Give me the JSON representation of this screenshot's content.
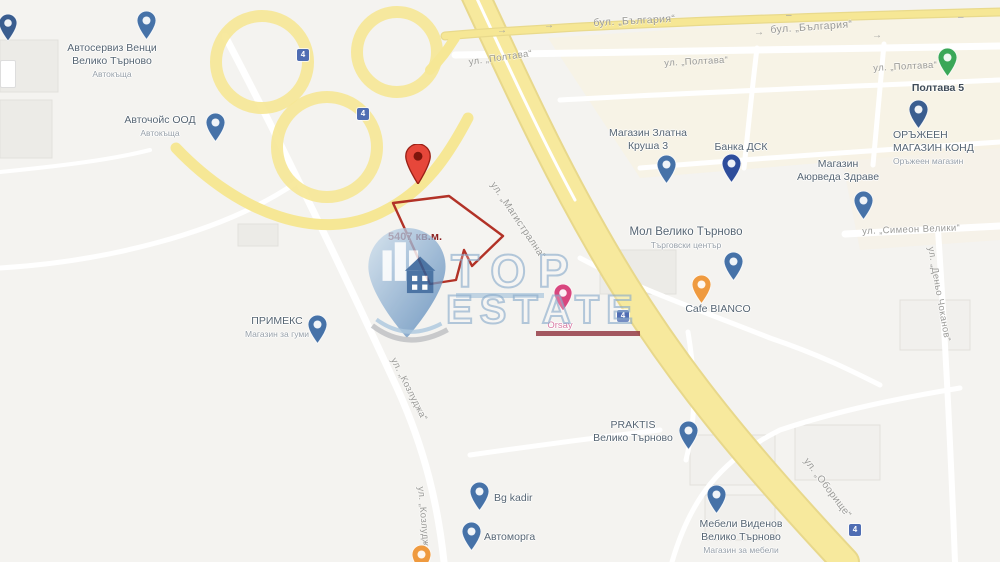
{
  "map_title": "Veliko Tarnovo map with plot outline",
  "parcel": {
    "area_label": "5407 кв.м.",
    "outline_color": "#b23227"
  },
  "marker": {
    "color": "#e6473a",
    "dot_color": "#7e150c"
  },
  "watermark": {
    "line1": "TOP",
    "line2": "ESTATE",
    "letter_stroke": "#88aaca",
    "underline_top_color": "#a9c4dc",
    "underline_estate_color": "#8e2f3c",
    "logo": "house-pin-logo"
  },
  "road_shield_label": "4",
  "pois": [
    {
      "id": "dark-pin-topleft",
      "pin": {
        "x": 8,
        "y": 14,
        "color": "#3a5d8f",
        "scale": 0.9
      }
    },
    {
      "id": "avtoserviz-venci",
      "pin": {
        "x": 146,
        "y": 11,
        "color": "#4672a8",
        "scale": 0.95
      },
      "label": {
        "x": 112,
        "y": 42,
        "align": "center",
        "lines": [
          "Автосервиз Венци",
          "Велико Търново"
        ],
        "sub": "Автокъща"
      }
    },
    {
      "id": "avtochois-ood",
      "pin": {
        "x": 215,
        "y": 113,
        "color": "#4672a8",
        "scale": 0.95
      },
      "label": {
        "x": 160,
        "y": 114,
        "align": "center",
        "lines": [
          "Авточойс ООД"
        ],
        "sub": "Автокъща"
      }
    },
    {
      "id": "magazin-zlatna-krusha",
      "pin": {
        "x": 666,
        "y": 155,
        "color": "#4672a8",
        "scale": 0.95
      },
      "label": {
        "x": 648,
        "y": 127,
        "align": "center",
        "lines": [
          "Магазин Златна",
          "Круша 3"
        ]
      }
    },
    {
      "id": "banka-dsk",
      "pin": {
        "x": 731,
        "y": 154,
        "color": "#2e4d9b",
        "scale": 0.95
      },
      "label": {
        "x": 741,
        "y": 141,
        "align": "center",
        "lines": [
          "Банка ДСК"
        ]
      }
    },
    {
      "id": "magazin-ayurveda-zdrave",
      "pin": {
        "x": 863,
        "y": 191,
        "color": "#4672a8",
        "scale": 0.95
      },
      "label": {
        "x": 838,
        "y": 158,
        "align": "center",
        "lines": [
          "Магазин",
          "Аюрведа Здраве"
        ]
      }
    },
    {
      "id": "poltava-5",
      "pin": {
        "x": 947,
        "y": 48,
        "color": "#3aa757",
        "scale": 0.95
      },
      "label": {
        "x": 938,
        "y": 82,
        "align": "center",
        "lines": [
          "Полтава 5"
        ],
        "color": "#3f4b57",
        "bold": true
      }
    },
    {
      "id": "orazheen-magazin-kond",
      "pin": {
        "x": 918,
        "y": 100,
        "color": "#3a5d8f",
        "scale": 0.95
      },
      "label": {
        "x": 893,
        "y": 129,
        "align": "left",
        "lines": [
          "ОРЪЖЕЕН",
          "МАГАЗИН КОНД"
        ],
        "sub": "Оръжеен магазин"
      }
    },
    {
      "id": "mol-veliko-tarnovo",
      "pin": {
        "x": 733,
        "y": 252,
        "color": "#4672a8",
        "scale": 0.95
      },
      "label": {
        "x": 686,
        "y": 225,
        "align": "center",
        "lines": [
          "Мол Велико Търново"
        ],
        "sub": "Търговски център",
        "size": 11.5
      }
    },
    {
      "id": "cafe-bianco",
      "pin": {
        "x": 701,
        "y": 275,
        "color": "#ef9a3f",
        "scale": 0.95
      },
      "label": {
        "x": 718,
        "y": 303,
        "align": "center",
        "lines": [
          "Cafe BIANCO"
        ]
      }
    },
    {
      "id": "primeks",
      "pin": {
        "x": 317,
        "y": 315,
        "color": "#4672a8",
        "scale": 0.95
      },
      "label": {
        "x": 277,
        "y": 315,
        "align": "center",
        "lines": [
          "ПРИМЕКС"
        ],
        "sub": "Магазин за гуми"
      }
    },
    {
      "id": "praktis",
      "pin": {
        "x": 688,
        "y": 421,
        "color": "#4672a8",
        "scale": 0.95
      },
      "label": {
        "x": 633,
        "y": 419,
        "align": "center",
        "lines": [
          "PRAKTIS",
          "Велико Търново"
        ]
      }
    },
    {
      "id": "bg-kadir",
      "pin": {
        "x": 479,
        "y": 482,
        "color": "#4672a8",
        "scale": 0.95
      },
      "label": {
        "x": 494,
        "y": 492,
        "align": "left",
        "lines": [
          "Bg kadir"
        ]
      }
    },
    {
      "id": "avtomorga",
      "pin": {
        "x": 471,
        "y": 522,
        "color": "#4672a8",
        "scale": 0.95
      },
      "label": {
        "x": 484,
        "y": 531,
        "align": "left",
        "lines": [
          "Автоморга"
        ]
      }
    },
    {
      "id": "mebeli-videnov",
      "pin": {
        "x": 716,
        "y": 485,
        "color": "#4672a8",
        "scale": 0.95
      },
      "label": {
        "x": 741,
        "y": 518,
        "align": "center",
        "lines": [
          "Мебели Виденов",
          "Велико Търново"
        ],
        "sub": "Магазин за мебели"
      }
    },
    {
      "id": "orsay-shop",
      "pin": {
        "x": 563,
        "y": 284,
        "color": "#d8467e",
        "scale": 0.9
      },
      "label": {
        "x": 560,
        "y": 320,
        "align": "center",
        "lines": [
          "Orsay"
        ],
        "color": "#d87ba4",
        "size": 9.5
      }
    },
    {
      "id": "orange-pin-bottom",
      "pin": {
        "x": 421,
        "y": 545,
        "color": "#ef9a3f",
        "scale": 0.95
      }
    }
  ],
  "street_labels": [
    {
      "text": "бул. „България“",
      "x": 593,
      "y": 17,
      "rot": -3,
      "size": 10.5
    },
    {
      "text": "бул. „България“",
      "x": 770,
      "y": 24,
      "rot": -4,
      "size": 10.5
    },
    {
      "text": "ул. „Полтава“",
      "x": 468,
      "y": 57,
      "rot": -8
    },
    {
      "text": "ул. „Полтава“",
      "x": 664,
      "y": 58,
      "rot": -3
    },
    {
      "text": "ул. „Полтава“",
      "x": 873,
      "y": 63,
      "rot": -3
    },
    {
      "text": "ул. „Магистрална“",
      "x": 497,
      "y": 180,
      "rot": 56,
      "size": 10
    },
    {
      "text": "ул. „Оборище“",
      "x": 810,
      "y": 456,
      "rot": 53,
      "size": 10
    },
    {
      "text": "ул. „Симеон Велики“",
      "x": 862,
      "y": 226,
      "rot": -2
    },
    {
      "text": "ул. „Деньо Чоканов“",
      "x": 936,
      "y": 246,
      "rot": 80
    },
    {
      "text": "ул. „Козлуджа“",
      "x": 398,
      "y": 356,
      "rot": 63
    },
    {
      "text": "ул. „Козлуджа“",
      "x": 426,
      "y": 486,
      "rot": 85
    }
  ],
  "arrows": [
    {
      "x": 497,
      "y": 25,
      "t": "→"
    },
    {
      "x": 544,
      "y": 20,
      "t": "→"
    },
    {
      "x": 754,
      "y": 27,
      "t": "→"
    },
    {
      "x": 872,
      "y": 30,
      "t": "→"
    },
    {
      "x": 786,
      "y": 10,
      "t": "–"
    },
    {
      "x": 958,
      "y": 12,
      "t": "–"
    }
  ],
  "shields": [
    {
      "x": 297,
      "y": 49
    },
    {
      "x": 357,
      "y": 108
    },
    {
      "x": 617,
      "y": 310
    },
    {
      "x": 849,
      "y": 524
    }
  ]
}
